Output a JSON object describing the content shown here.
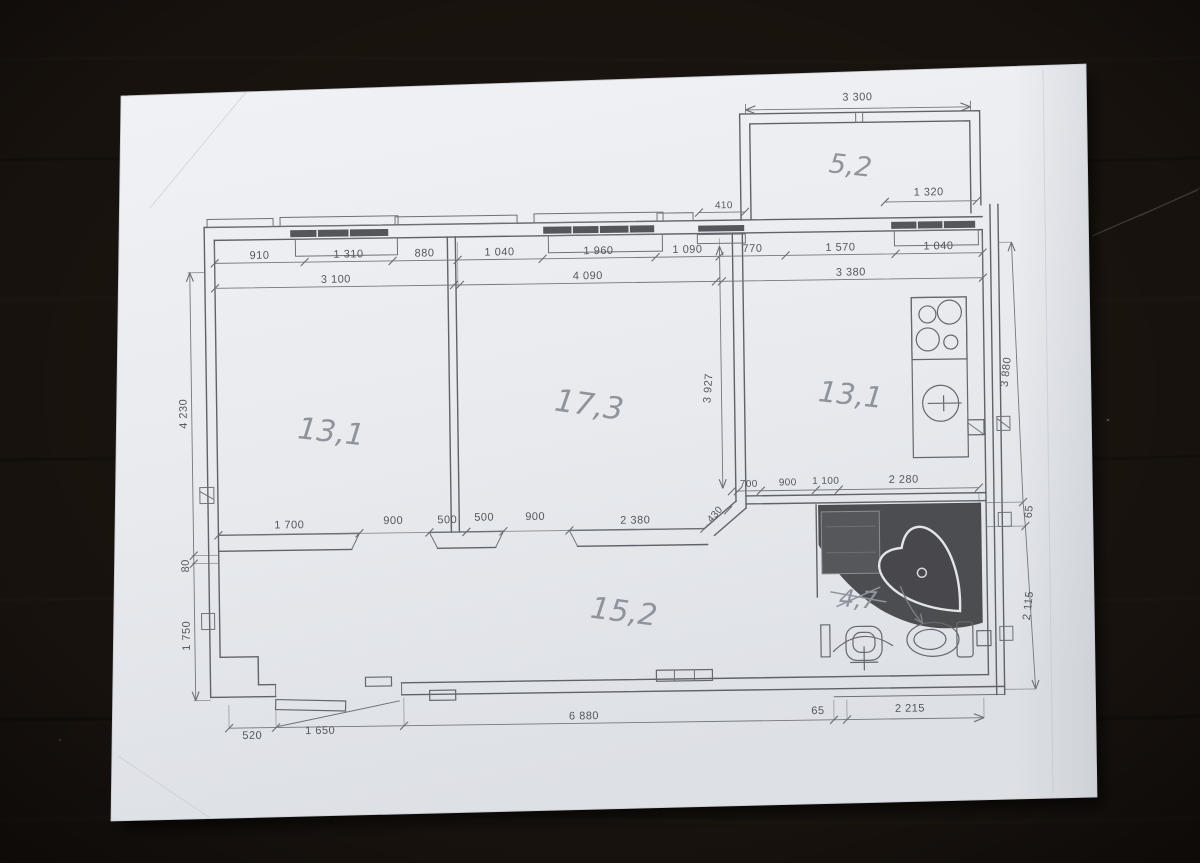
{
  "scene": {
    "table_color": "#1d1611",
    "paper_color": "#e9ebee",
    "print_line_color": "#5f6369",
    "pencil_color": "#8f949c"
  },
  "plan": {
    "rooms": {
      "left_room": "13,1",
      "middle_room": "17,3",
      "kitchen": "13,1",
      "hallway": "15,2",
      "balcony": "5,2",
      "bathroom": "4,7"
    },
    "dims": {
      "balcony_width": "3 300",
      "balcony_side": "1 320",
      "balcony_door": "410",
      "top_row": [
        "910",
        "1 310",
        "880",
        "1 040",
        "1 960",
        "1 090",
        "770",
        "1 570",
        "1 040"
      ],
      "top_subtotals": [
        "3 100",
        "4 090",
        "3 380"
      ],
      "left_col": [
        "4 230",
        "80",
        "1 750"
      ],
      "right_col": [
        "3 880",
        "65",
        "2 115"
      ],
      "room2_depth": "3 927",
      "inner_row": [
        "1 700",
        "900",
        "500",
        "500",
        "900",
        "2 380",
        "430"
      ],
      "bath_row": [
        "700",
        "900",
        "1 100",
        "2 280"
      ],
      "bottom_row": [
        "520",
        "1 650",
        "6 880",
        "65",
        "2 215"
      ]
    }
  }
}
